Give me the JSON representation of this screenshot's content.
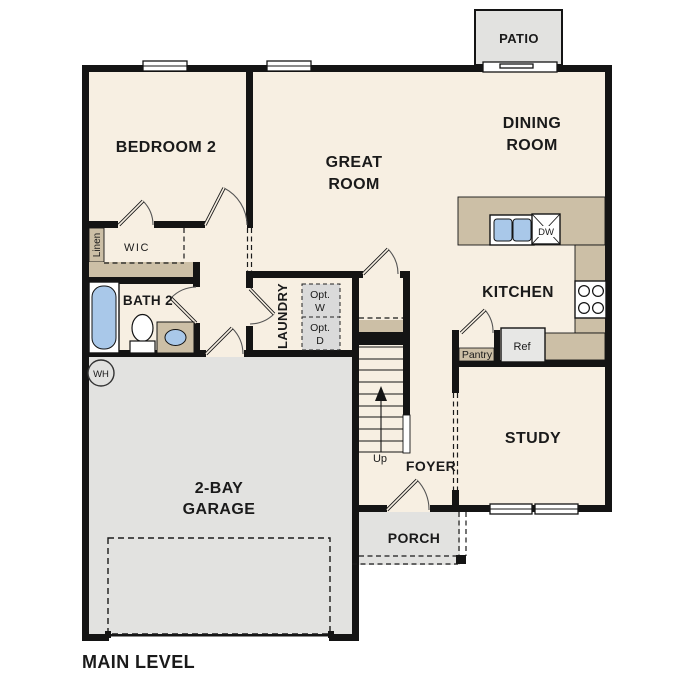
{
  "plan": {
    "level_label": "MAIN LEVEL",
    "rooms": {
      "patio": {
        "label": "PATIO"
      },
      "bedroom2": {
        "label": "BEDROOM 2"
      },
      "great_room": {
        "line1": "GREAT",
        "line2": "ROOM"
      },
      "dining_room": {
        "line1": "DINING",
        "line2": "ROOM"
      },
      "kitchen": {
        "label": "KITCHEN"
      },
      "study": {
        "label": "STUDY"
      },
      "foyer": {
        "label": "FOYER"
      },
      "porch": {
        "label": "PORCH"
      },
      "garage": {
        "line1": "2-BAY",
        "line2": "GARAGE"
      },
      "bath2": {
        "label": "BATH 2"
      },
      "laundry": {
        "label": "LAUNDRY"
      },
      "wic": {
        "label": "WIC"
      },
      "linen": {
        "label": "Linen"
      },
      "pantry": {
        "label": "Pantry"
      }
    },
    "fixtures": {
      "refrigerator": {
        "label": "Ref"
      },
      "dishwasher": {
        "label": "DW"
      },
      "opt_washer": {
        "line1": "Opt.",
        "line2": "W"
      },
      "opt_dryer": {
        "line1": "Opt.",
        "line2": "D"
      },
      "water_heater": {
        "label": "WH"
      },
      "stair_direction": {
        "label": "Up"
      }
    },
    "colors": {
      "wall": "#141414",
      "floor": "#f7efe2",
      "accent_tan": "#ccbfa6",
      "concrete_gray": "#e2e2e0",
      "appliance_gray": "#dadada",
      "fixture_blue": "#a9c8e9"
    }
  }
}
